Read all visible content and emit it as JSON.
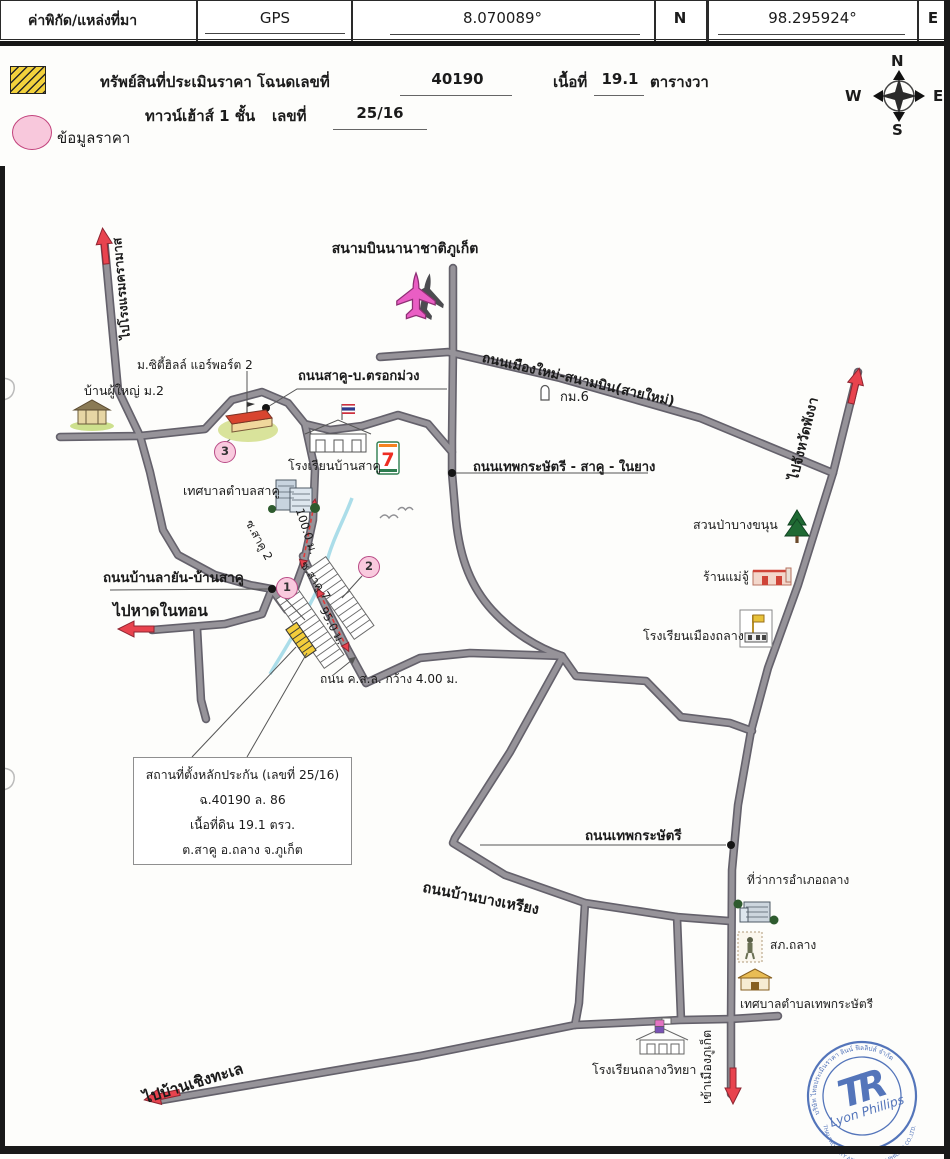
{
  "header": {
    "title": "ค่าพิกัด/แหล่งที่มา",
    "source": "GPS",
    "latitude": "8.070089°",
    "lat_hemisphere": "N",
    "longitude": "98.295924°",
    "lng_hemisphere": "E"
  },
  "legend": {
    "property_prefix": "ทรัพย์สินที่ประเมินราคา โฉนดเลขที่",
    "deed_no": "40190",
    "area_label": "เนื้อที่",
    "area_value": "19.1",
    "area_unit": "ตารางวา",
    "building_type": "ทาวน์เฮ้าส์ 1 ชั้น",
    "house_no_label": "เลขที่",
    "house_no": "25/16",
    "price_info_label": "ข้อมูลราคา"
  },
  "compass": {
    "n": "N",
    "w": "W",
    "e": "E",
    "s": "S"
  },
  "map": {
    "labels": {
      "airport": "สนามบินนานาชาติภูเก็ต",
      "hotel_road": "ไปโรงแรมครามาส",
      "new_road": "ถนนเมืองใหม่-สนามบิน(สายใหม่)",
      "km6": "กม.6",
      "sakhu_trokmuang": "ถนนสาคู-บ.ตรอกม่วง",
      "city_hill": "ม.ซิตี้ฮิลล์ แอร์พอร์ต 2",
      "ban_phuyai": "บ้านผู้ใหญ่ ม.2",
      "school_ban_sakhu": "โรงเรียนบ้านสาคู",
      "sakhu_municipality": "เทศบาลตำบลสาคู",
      "soi_sakhu2": "ซ.สาคู 2",
      "dist_100": "100.0 ม.",
      "soi_sakhu7": "ซ.สาคู 7",
      "dist_95": "95.0 ม.",
      "layan_sakhu_road": "ถนนบ้านลายัน-บ้านสาคู",
      "naithon": "ไปหาดในทอน",
      "csl_road": "ถนน ค.ส.ล. กว้าง 4.00 ม.",
      "thep_sakhu_naiyang": "ถนนเทพกระษัตรี - สาคู - ในยาง",
      "phangnga": "ไปจังหวัดพังงา",
      "forest": "สวนป่าบางขนุน",
      "mae_ju": "ร้านแม่จู้",
      "school_muang_thalang": "โรงเรียนเมืองถลาง",
      "thep_road": "ถนนเทพกระษัตรี",
      "district_office": "ที่ว่าการอำเภอถลาง",
      "police": "สภ.ถลาง",
      "thep_municipality": "เทศบาลตำบลเทพกระษัตรี",
      "bangriang_road": "ถนนบ้านบางเหรียง",
      "school_thalang_witthaya": "โรงเรียนถลางวิทยา",
      "cherngtalay": "ไปบ้านเชิงทะเล",
      "to_city": "เข้าเมืองภูเก็ต",
      "seven_eleven": "7"
    },
    "markers": {
      "m1": "1",
      "m2": "2",
      "m3": "3"
    },
    "info_box": {
      "line1": "สถานที่ตั้งหลักประกัน (เลขที่ 25/16)",
      "line2": "ฉ.40190 ล. 86",
      "line3": "เนื้อที่ดิน 19.1 ตรว.",
      "line4": "ต.สาคู อ.ถลาง จ.ภูเก็ต"
    }
  },
  "stamp": {
    "monogram": "TR",
    "name": "Lyon Phillips",
    "arc_top": "บริษัท ไทยประเมินราคา ลินน์ ฟิลลิปส์ จำกัด",
    "arc_bottom": "THAI PROPERTY APPRAISAL LYNN PHILLIPS CO.,LTD."
  }
}
